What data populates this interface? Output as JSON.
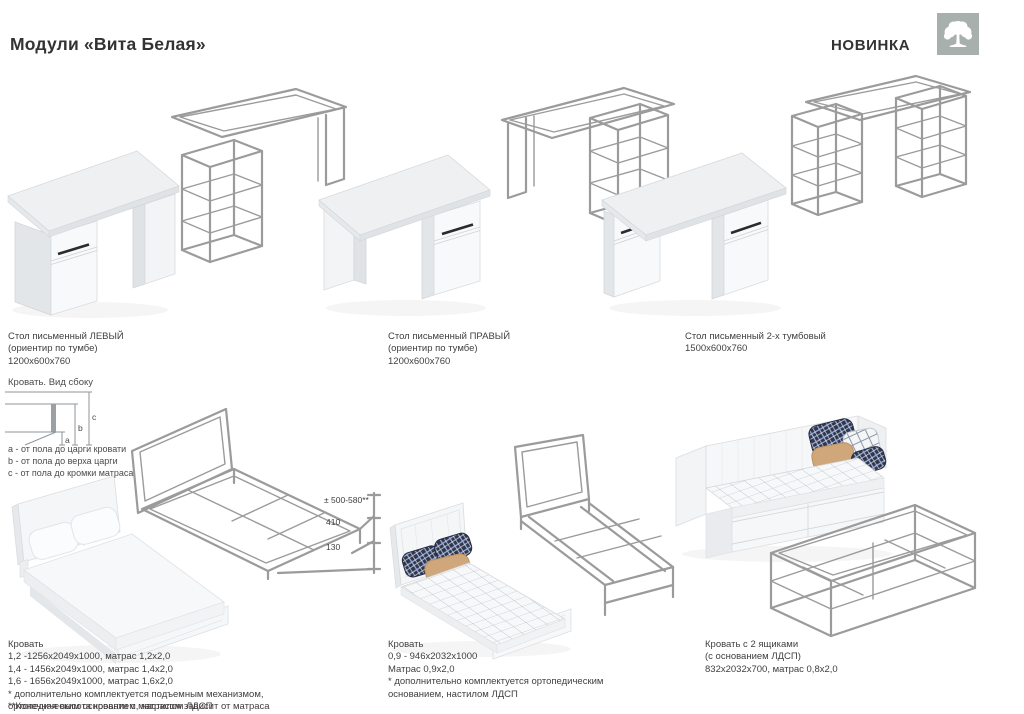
{
  "header": {
    "title": "Модули «Вита Белая»",
    "badge": "НОВИНКА",
    "brand_icon": "tree-icon"
  },
  "colors": {
    "wireframe_gray": "#9b9b9b",
    "brand_square": "#a7b0ac",
    "text": "#3f3f3f",
    "handle_black": "#2b2b2b"
  },
  "desks": [
    {
      "lines": [
        "Стол письменный ЛЕВЫЙ",
        "(ориентир по тумбе)",
        "1200x600x760"
      ]
    },
    {
      "lines": [
        "Стол письменный ПРАВЫЙ",
        "(ориентир по тумбе)",
        "1200x600x760"
      ]
    },
    {
      "lines": [
        "Стол письменный 2-х тумбовый",
        "1500x600x760"
      ]
    }
  ],
  "side_view": {
    "title": "Кровать. Вид сбоку",
    "dims": {
      "a": "a",
      "b": "b",
      "c": "c"
    },
    "legend": [
      "a - от пола до царги кровати",
      "b - от пола до верха царги",
      "c - от пола до кромки матраса"
    ]
  },
  "bed1": {
    "dims": {
      "d1": "± 500-580**",
      "d2": "410",
      "d3": "130"
    },
    "lines": [
      "Кровать",
      "1,2 -1256x2049x1000, матрас 1,2x2,0",
      "1,4 - 1456x2049x1000, матрас 1,4x2,0",
      "1,6 - 1656x2049x1000, матрас 1,6x2,0",
      "* дополнительно комплектуется подъемным механизмом,",
      "ортопедическим основанием, настилом ЛДСП"
    ],
    "footnote": "**Конечная высота кровати с матрасом зависит от матраса"
  },
  "bed2": {
    "lines": [
      "Кровать",
      "0,9 - 946x2032x1000",
      "Матрас 0,9x2,0",
      "* дополнительно комплектуется ортопедическим",
      "основанием, настилом ЛДСП"
    ]
  },
  "bed3": {
    "lines": [
      "Кровать с 2 ящиками",
      "(с основанием ЛДСП)",
      "832x2032x700, матрас 0,8x2,0"
    ]
  }
}
